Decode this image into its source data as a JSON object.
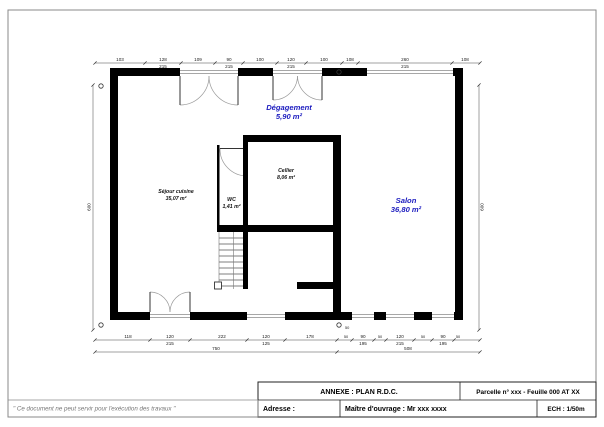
{
  "sheet": {
    "note": "\" Ce document ne peut servir pour l'exécution des travaux \"",
    "title_block": {
      "annexe": "ANNEXE : PLAN R.D.C.",
      "parcelle": "Parcelle n° xxx - Feuille 000 AT XX",
      "adresse_label": "Adresse :",
      "maitre_ouvrage": "Maître d'ouvrage : Mr xxx xxxx",
      "echelle": "ECH : 1/50m"
    }
  },
  "plan": {
    "rooms": [
      {
        "id": "degagement",
        "name": "Dégagement",
        "area": "5,90 m²",
        "color": "#1b1bbf"
      },
      {
        "id": "sejour-cuisine",
        "name": "Séjour cuisine",
        "area": "35,07 m²",
        "color": "#111111"
      },
      {
        "id": "wc",
        "name": "WC",
        "area": "1,41 m²",
        "color": "#111111"
      },
      {
        "id": "cellier",
        "name": "Cellier",
        "area": "8,06 m²",
        "color": "#111111"
      },
      {
        "id": "salon",
        "name": "Salon",
        "area": "36,80 m²",
        "color": "#1b1bbf"
      }
    ],
    "dimensions": {
      "top": [
        "103",
        "128|215",
        "109",
        "90|215",
        "100",
        "120|215",
        "100",
        "108",
        "260|215",
        "108"
      ],
      "bottom": [
        "118",
        "120|215",
        "222",
        "120|125",
        "178",
        "50",
        "90|195",
        "50",
        "120|215",
        "50",
        "90|195",
        "50"
      ],
      "bottom_totals": [
        "750",
        "508"
      ],
      "left": "600",
      "right": "600"
    },
    "markers": {
      "symbol": "O",
      "subscript": "50"
    },
    "colors": {
      "wall": "#000000",
      "dim_line": "#444444",
      "swing": "#9a9a9a",
      "glazing": "#8a8a8a"
    }
  }
}
